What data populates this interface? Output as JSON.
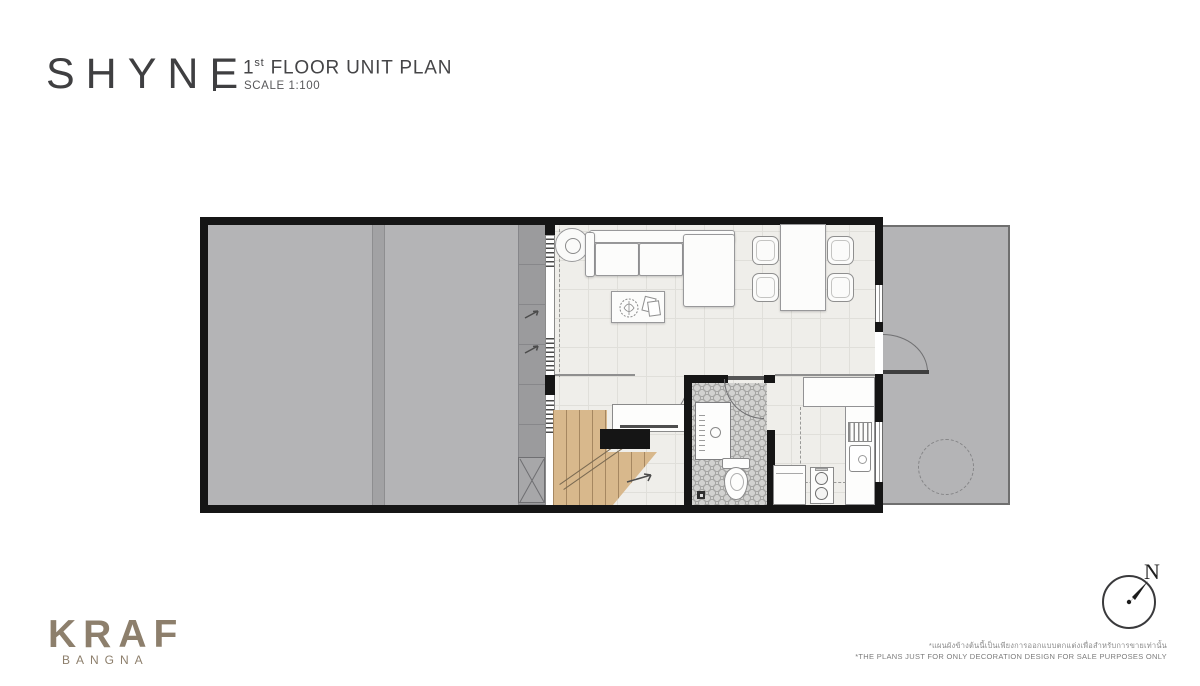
{
  "header": {
    "project_name": "SHYNE",
    "plan_title": {
      "number": "1",
      "ordinal": "st",
      "rest": " FLOOR UNIT PLAN"
    },
    "scale_label": "SCALE 1:100"
  },
  "compass": {
    "north_label": "N"
  },
  "footer": {
    "logo_text": "KRAF",
    "logo_subtext": "BANGNA",
    "disclaimer_th": "*แผนผังข้างต้นนี้เป็นเพียงการออกแบบตกแต่งเพื่อสำหรับการขายเท่านั้น",
    "disclaimer_en": "*THE PLANS JUST FOR ONLY DECORATION DESIGN FOR SALE PURPOSES ONLY"
  },
  "colors": {
    "logo": "#8d7f6c",
    "title_text": "#3f3f41",
    "wall": "#151515",
    "outdoor_gray": "#b4b4b6",
    "walkway_gray": "#9b9b9d",
    "interior_floor": "#efeeea",
    "stair_wood": "#d8b88c",
    "bath_tile": "#d2d2d0"
  }
}
